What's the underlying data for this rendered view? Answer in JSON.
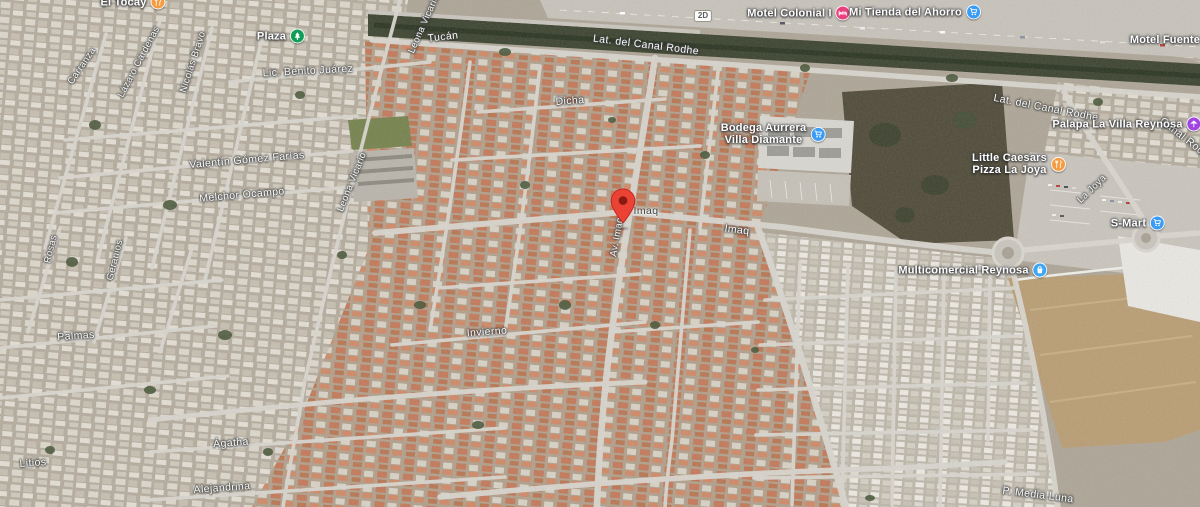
{
  "app": {
    "view": "satellite-map"
  },
  "map": {
    "highway_shield": "2D",
    "marker": {
      "description": "red location pin",
      "color": "#ea4335"
    },
    "pois": [
      {
        "label": "Plaza",
        "icon": "park-tree-icon",
        "color": "#0f9d58"
      },
      {
        "label": "El Tocay",
        "icon": "restaurant-icon",
        "color": "#f59b42"
      },
      {
        "label": "Motel Colonial I",
        "icon": "hotel-bed-icon",
        "color": "#e8417c"
      },
      {
        "label": "Mi Tienda del Ahorro",
        "icon": "shopping-cart-icon",
        "color": "#3b9cf5"
      },
      {
        "label": "Motel Fuente",
        "icon": "",
        "color": ""
      },
      {
        "label": "Bodega Aurrera Villa Diamante",
        "line1": "Bodega Aurrera",
        "line2": "Villa Diamante",
        "icon": "shopping-cart-icon",
        "color": "#3b9cf5"
      },
      {
        "label": "Palapa La Villa Reynosa",
        "icon": "palapa-icon",
        "color": "#a044e3"
      },
      {
        "label": "Little Caesars Pizza La Joya",
        "line1": "Little Caesars",
        "line2": "Pizza La Joya",
        "icon": "restaurant-icon",
        "color": "#f59b42"
      },
      {
        "label": "S-Mart",
        "icon": "shopping-cart-icon",
        "color": "#3b9cf5"
      },
      {
        "label": "Multicomercial Reynosa",
        "icon": "shopping-bag-icon",
        "color": "#41a6f2"
      }
    ],
    "streets": [
      {
        "name": "Lic. Benito Juárez"
      },
      {
        "name": "Lázaro Cárdenas"
      },
      {
        "name": "Nicolás Bravo"
      },
      {
        "name": "Carranza"
      },
      {
        "name": "Leona Vicario"
      },
      {
        "name": "Tucán"
      },
      {
        "name": "Lat. del Canal Rodhe"
      },
      {
        "name": "Dicha"
      },
      {
        "name": "Valentín Gómez Farías"
      },
      {
        "name": "Melchor Ocampo"
      },
      {
        "name": "Leona Vicario"
      },
      {
        "name": "Imaq"
      },
      {
        "name": "Av. Imaq"
      },
      {
        "name": "Imaq"
      },
      {
        "name": "Lat. del Canal Rodhe"
      },
      {
        "name": "Canal Rodhe"
      },
      {
        "name": "Rosas"
      },
      {
        "name": "Geranios"
      },
      {
        "name": "Palmas"
      },
      {
        "name": "Invierno"
      },
      {
        "name": "Litios"
      },
      {
        "name": "Ágatha"
      },
      {
        "name": "Alejandrina"
      },
      {
        "name": "La Joya"
      },
      {
        "name": "P. Media Luna"
      }
    ]
  }
}
